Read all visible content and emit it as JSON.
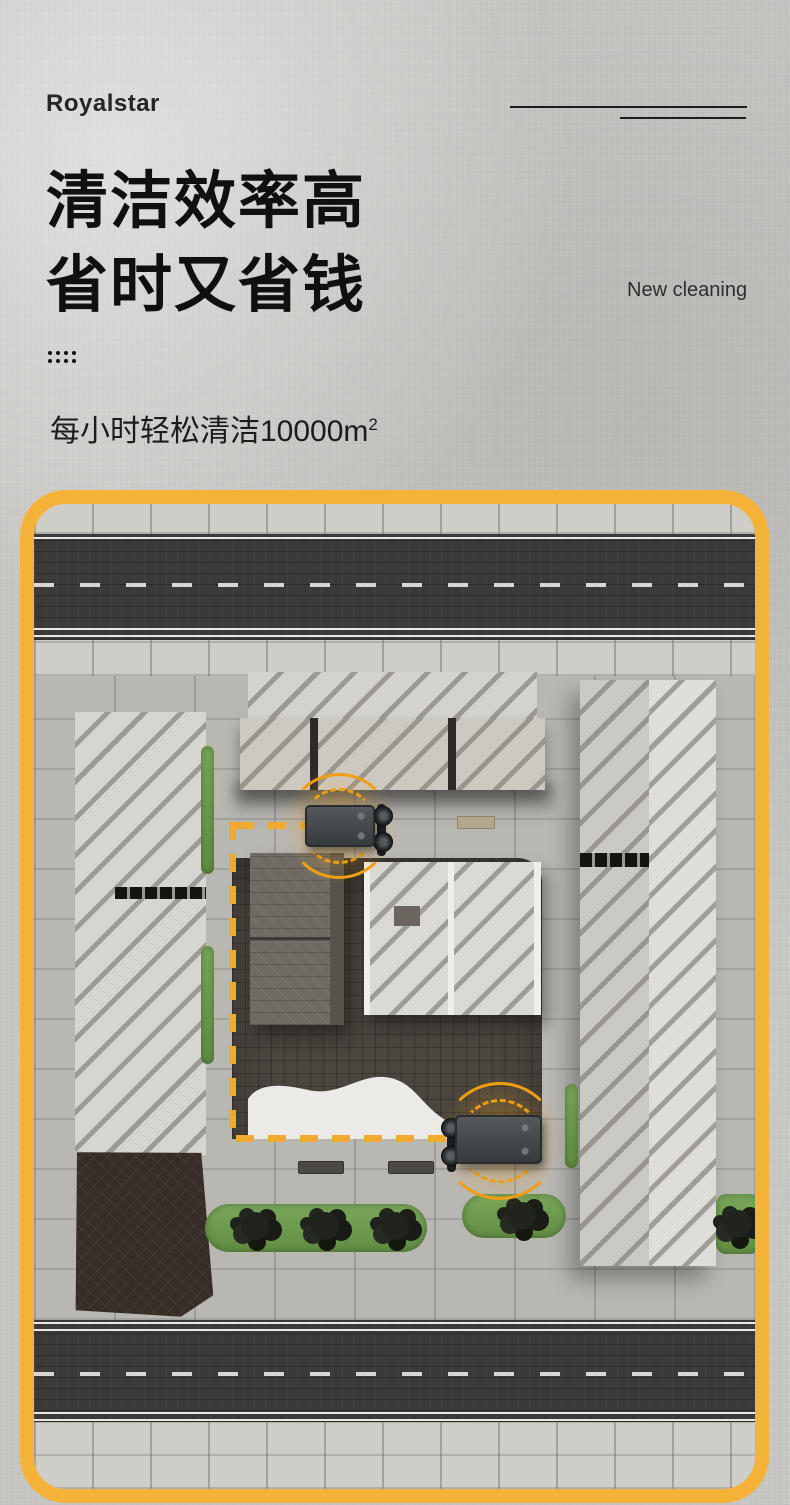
{
  "header": {
    "logo": "Royalstar",
    "title_line1": "清洁效率高",
    "title_line2": "省时又省钱",
    "eyebrow": "New cleaning",
    "subtitle_text": "每小时轻松清洁10000m",
    "subtitle_sup": "2"
  },
  "scene": {
    "panel_border_color": "#f4b338",
    "path_dash_color": "#f0ab2e",
    "signal_arc_color": "#ef9d13",
    "road_color": "#3b3a38",
    "grass_color": "#6d9c4d",
    "courtyard_color": "#4a453e",
    "robot_count": 2
  }
}
